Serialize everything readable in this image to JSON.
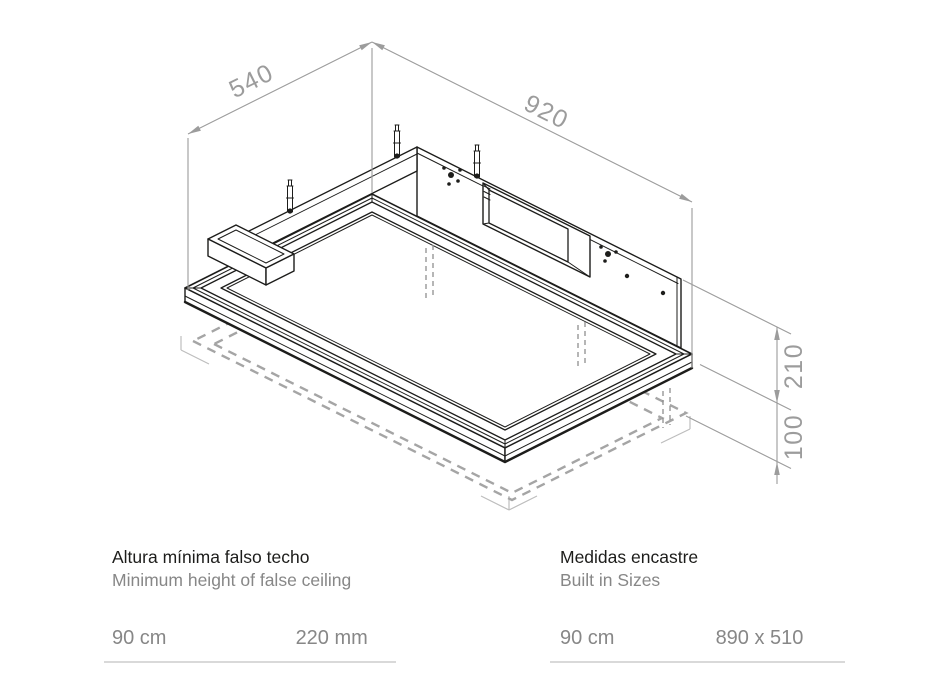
{
  "diagram": {
    "dim_540": "540",
    "dim_920": "920",
    "dim_210": "210",
    "dim_100": "100",
    "line_color": "#1d1d1b",
    "dim_color": "#9c9c9c",
    "dash_color": "#a5a5a5",
    "rule_color": "#d9d9d9"
  },
  "specs": {
    "left": {
      "title": "Altura mínima falso techo",
      "subtitle": "Minimum height of false ceiling",
      "value1": "90 cm",
      "value2": "220 mm"
    },
    "right": {
      "title": "Medidas encastre",
      "subtitle": "Built in Sizes",
      "value1": "90 cm",
      "value2": "890 x 510"
    }
  }
}
